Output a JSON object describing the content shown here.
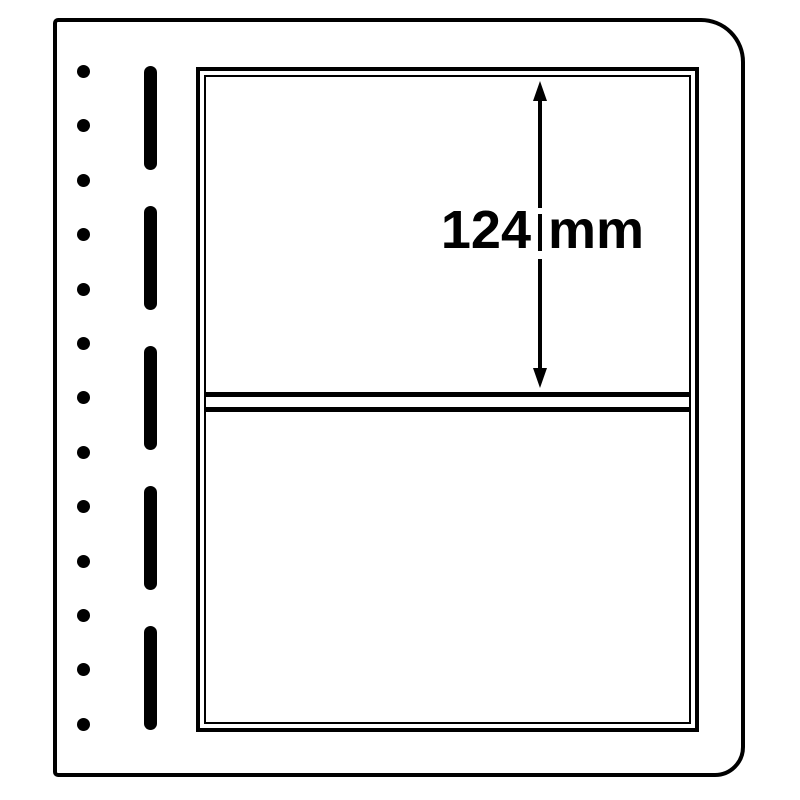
{
  "colors": {
    "paper": "#ffffff",
    "ink": "#000000"
  },
  "sheet": {
    "punch_hole_count": 13,
    "perforation_dash_count": 5,
    "pocket_count": 2
  },
  "dimension": {
    "label": "124 mm",
    "value": "124",
    "unit": "mm"
  }
}
